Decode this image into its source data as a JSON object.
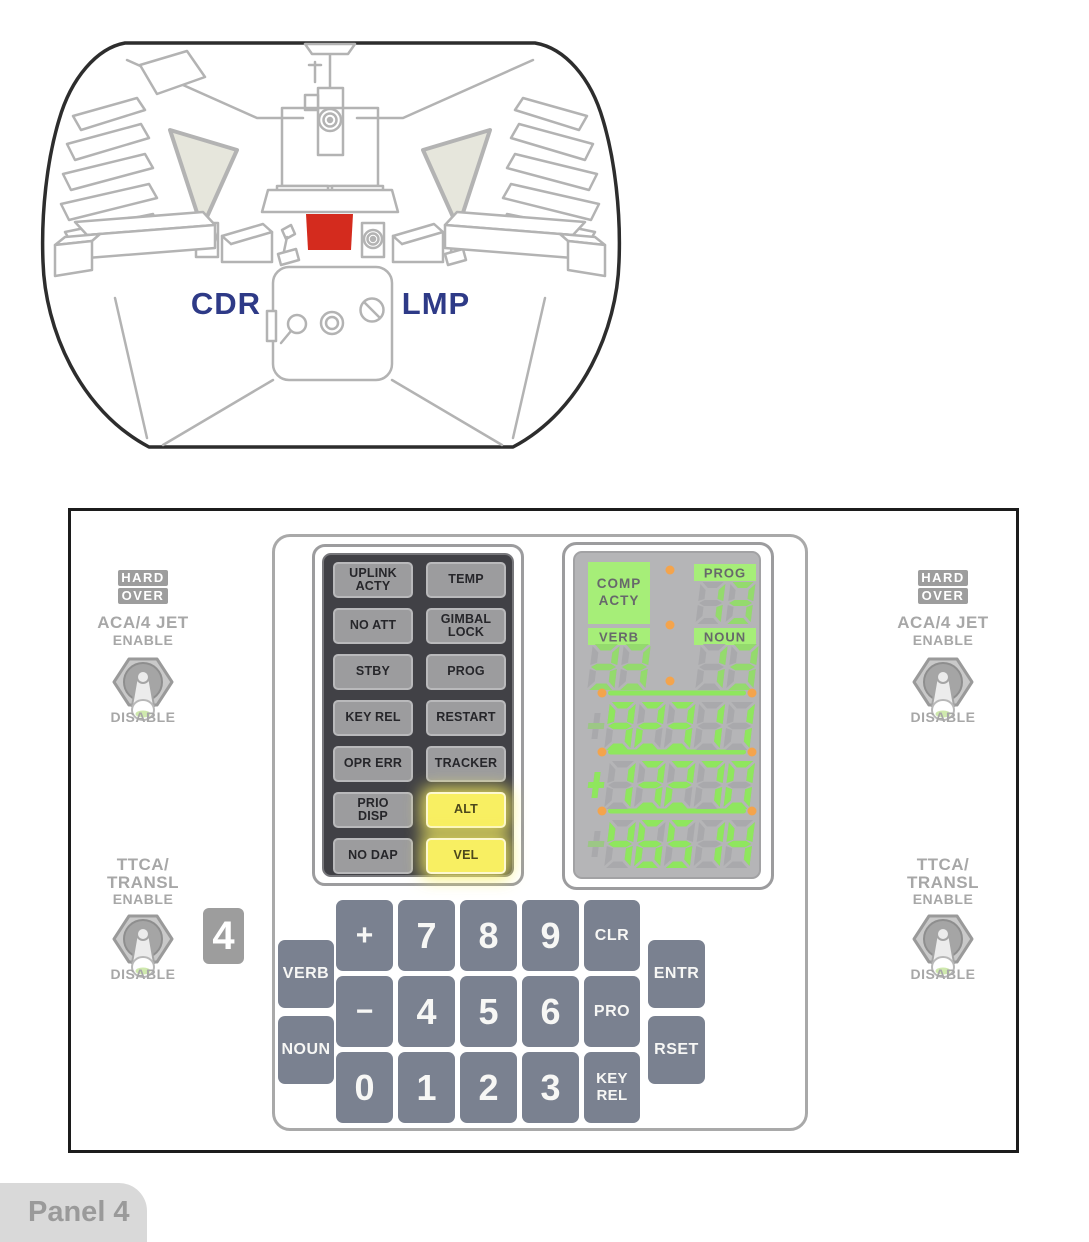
{
  "cockpit": {
    "cdr_label": "CDR",
    "lmp_label": "LMP"
  },
  "panel_tag": "Panel 4",
  "badge": "4",
  "controls": {
    "left": {
      "hard": "HARD",
      "over": "OVER",
      "jet_title": "ACA/4 JET",
      "jet_enable": "ENABLE",
      "jet_disable": "DISABLE",
      "ttca_title": "TTCA/",
      "ttca_sub": "TRANSL",
      "ttca_enable": "ENABLE",
      "ttca_disable": "DISABLE"
    },
    "right": {
      "hard": "HARD",
      "over": "OVER",
      "jet_title": "ACA/4 JET",
      "jet_enable": "ENABLE",
      "jet_disable": "DISABLE",
      "ttca_title": "TTCA/",
      "ttca_sub": "TRANSL",
      "ttca_enable": "ENABLE",
      "ttca_disable": "DISABLE"
    }
  },
  "warning_lights": [
    {
      "lines": [
        "UPLINK",
        "ACTY"
      ],
      "lit": false
    },
    {
      "lines": [
        "TEMP"
      ],
      "lit": false
    },
    {
      "lines": [
        "NO ATT"
      ],
      "lit": false
    },
    {
      "lines": [
        "GIMBAL",
        "LOCK"
      ],
      "lit": false
    },
    {
      "lines": [
        "STBY"
      ],
      "lit": false
    },
    {
      "lines": [
        "PROG"
      ],
      "lit": false
    },
    {
      "lines": [
        "KEY REL"
      ],
      "lit": false
    },
    {
      "lines": [
        "RESTART"
      ],
      "lit": false
    },
    {
      "lines": [
        "OPR ERR"
      ],
      "lit": false
    },
    {
      "lines": [
        "TRACKER"
      ],
      "lit": false
    },
    {
      "lines": [
        "PRIO",
        "DISP"
      ],
      "lit": false
    },
    {
      "lines": [
        "ALT"
      ],
      "lit": true
    },
    {
      "lines": [
        "NO DAP"
      ],
      "lit": false
    },
    {
      "lines": [
        "VEL"
      ],
      "lit": true
    }
  ],
  "display": {
    "comp_acty_lines": [
      "COMP",
      "ACTY"
    ],
    "prog_label": "PROG",
    "verb_label": "VERB",
    "noun_label": "NOUN",
    "prog_value": "13",
    "verb_value": "33",
    "noun_value": "13",
    "registers": [
      "-92311",
      "+13270",
      "-46514"
    ]
  },
  "keypad": {
    "keys": [
      {
        "id": "verb",
        "label": "VERB",
        "style": "word"
      },
      {
        "id": "noun",
        "label": "NOUN",
        "style": "word"
      },
      {
        "id": "plus",
        "label": "+",
        "style": "sign"
      },
      {
        "id": "minus",
        "label": "−",
        "style": "sign"
      },
      {
        "id": "zero",
        "label": "0",
        "style": "digit"
      },
      {
        "id": "seven",
        "label": "7",
        "style": "digit"
      },
      {
        "id": "four",
        "label": "4",
        "style": "digit"
      },
      {
        "id": "one",
        "label": "1",
        "style": "digit"
      },
      {
        "id": "eight",
        "label": "8",
        "style": "digit"
      },
      {
        "id": "five",
        "label": "5",
        "style": "digit"
      },
      {
        "id": "two",
        "label": "2",
        "style": "digit"
      },
      {
        "id": "nine",
        "label": "9",
        "style": "digit"
      },
      {
        "id": "six",
        "label": "6",
        "style": "digit"
      },
      {
        "id": "three",
        "label": "3",
        "style": "digit"
      },
      {
        "id": "clr",
        "label": "CLR",
        "style": "word"
      },
      {
        "id": "pro",
        "label": "PRO",
        "style": "word"
      },
      {
        "id": "key-rel",
        "label": "KEY\nREL",
        "style": "word2"
      },
      {
        "id": "entr",
        "label": "ENTR",
        "style": "word"
      },
      {
        "id": "rset",
        "label": "RSET",
        "style": "word"
      }
    ]
  },
  "colors": {
    "digit_green": "#8FE65E",
    "label_green": "#A6EE78",
    "orange_dot": "#F4A44C",
    "ghost_segment": "#A9A9AC",
    "display_bg": "#B5B5B7",
    "warning_panel_bg": "#414146",
    "warning_light_gray": "#9C9C9E",
    "lit_yellow": "#F8EF62",
    "key_gray": "#7A8190",
    "highlight_red": "#D42B1E",
    "crew_label_navy": "#2E3A87"
  }
}
